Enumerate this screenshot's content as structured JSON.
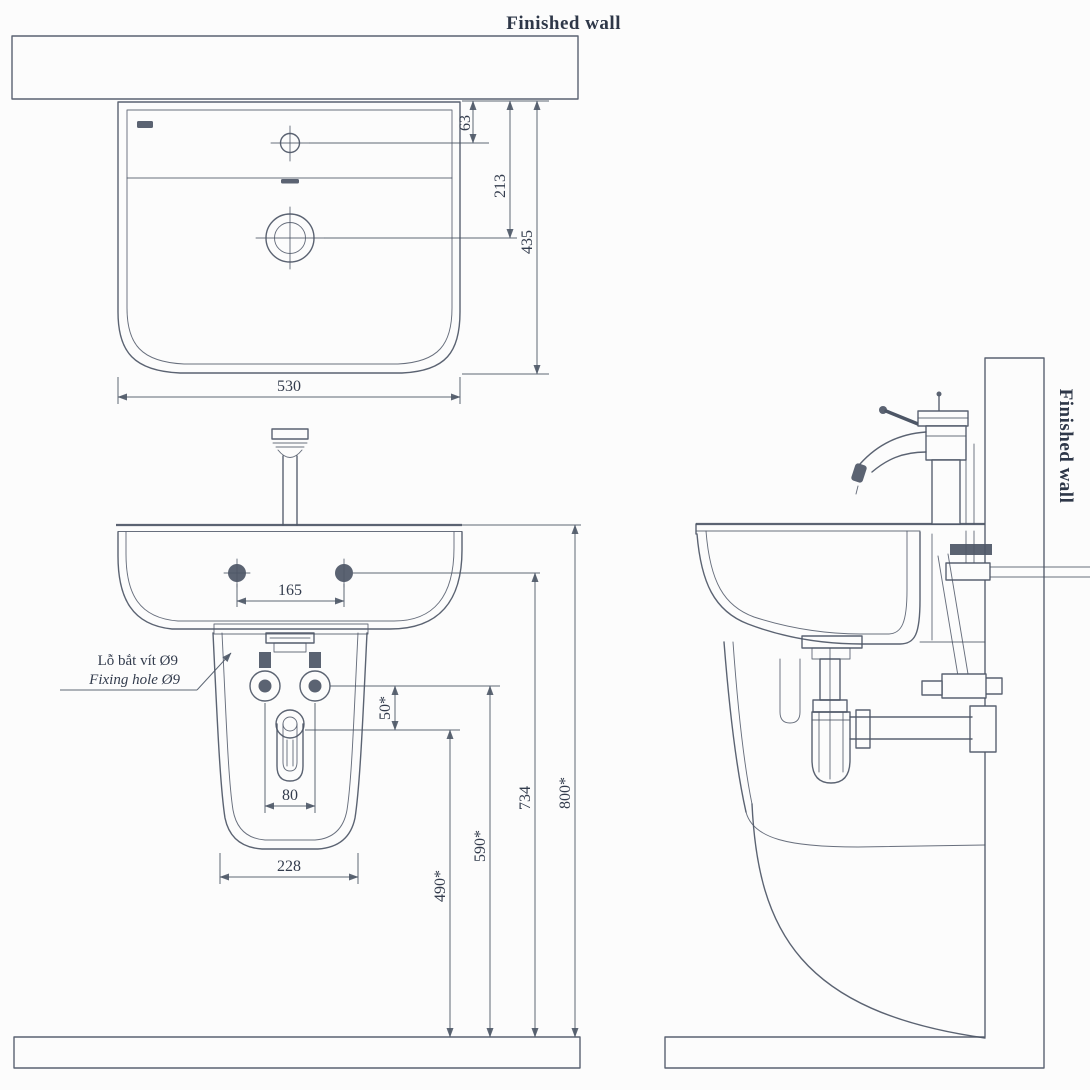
{
  "drawing": {
    "type": "technical installation drawing",
    "subject": "wall-hung lavatory with semi-pedestal, three orthographic views",
    "colors": {
      "line": "#4d5666",
      "text": "#333c4d",
      "stipple": "#9aa2b1",
      "background": "#fcfcfc"
    }
  },
  "labels": {
    "finished_wall_top": "Finished wall",
    "finished_wall_side": "Finished wall",
    "fixing_hole_vi": "Lỗ bắt vít Ø9",
    "fixing_hole_en": "Fixing hole Ø9"
  },
  "dims": {
    "d63": "63",
    "d213": "213",
    "d435": "435",
    "d530": "530",
    "d165": "165",
    "d80": "80",
    "d228": "228",
    "d50": "50*",
    "d490": "490*",
    "d590": "590*",
    "d734": "734",
    "d800": "800*"
  }
}
